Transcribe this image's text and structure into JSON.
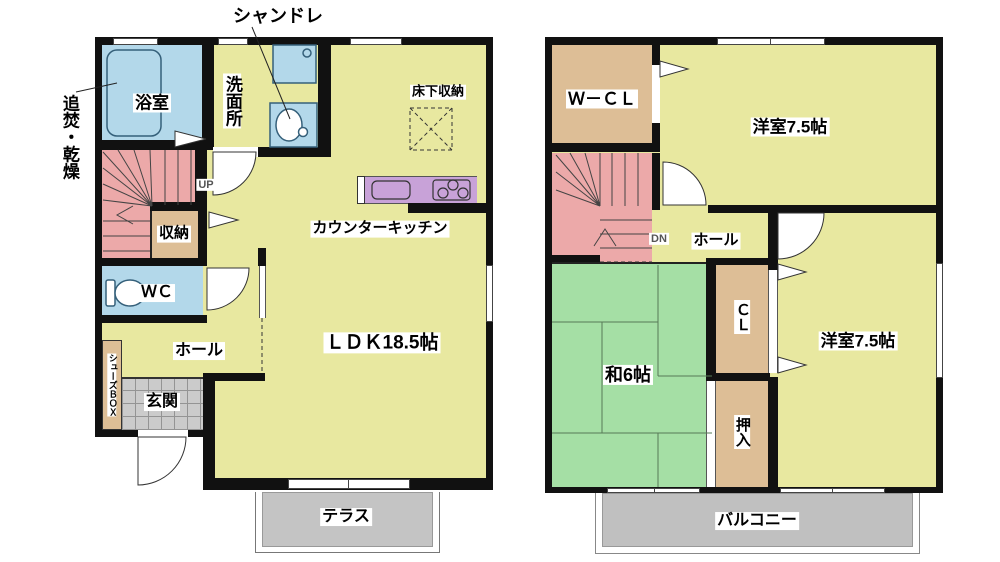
{
  "floor1": {
    "labels": {
      "chandelier": "シャンドレ",
      "reheat_dry": "追焚・乾燥",
      "bath": "浴室",
      "washroom": "洗面所",
      "up": "UP",
      "storage": "収納",
      "wc": "ＷＣ",
      "hall": "ホール",
      "shoes_box": "シューズＢＯＸ",
      "entrance": "玄関",
      "counter_kitchen": "カウンターキッチン",
      "underfloor_storage": "床下収納",
      "ldk": "ＬＤＫ18.5帖",
      "terrace": "テラス"
    }
  },
  "floor2": {
    "labels": {
      "walk_in_closet": "Ｗ－ＣＬ",
      "western_room_1": "洋室7.5帖",
      "down": "DN",
      "hall": "ホール",
      "japanese_room": "和6帖",
      "closet": "ＣＬ",
      "futon_closet": "押入",
      "western_room_2": "洋室7.5帖",
      "balcony": "バルコニー"
    }
  },
  "colors": {
    "room_yellow": "#e8e8a0",
    "wet_area_blue": "#b3d8ea",
    "stairs_pink": "#eca9a9",
    "closet_tan": "#ddbe96",
    "tatami_green": "#a5dfa5",
    "kitchen_purple": "#c8a2d8",
    "outdoor_gray": "#c4c4c4",
    "wall_black": "#111111"
  }
}
